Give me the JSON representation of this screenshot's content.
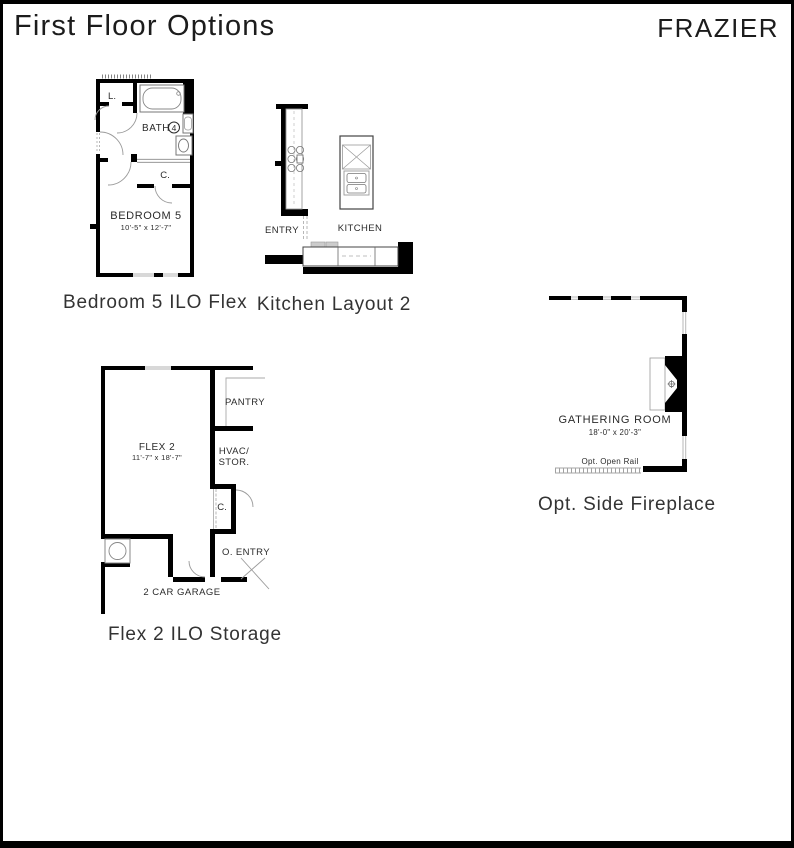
{
  "header": {
    "title": "First Floor Options",
    "brand": "FRAZIER"
  },
  "plans": {
    "bedroom5": {
      "caption": "Bedroom 5 ILO Flex",
      "linen": "L.",
      "bath": "BATH",
      "bath_number": "4",
      "closet": "C.",
      "room": "BEDROOM 5",
      "dims": "10'-5\" x 12'-7\""
    },
    "kitchen": {
      "caption": "Kitchen Layout 2",
      "entry": "ENTRY",
      "kitchen": "KITCHEN"
    },
    "fireplace": {
      "caption": "Opt. Side Fireplace",
      "room": "GATHERING ROOM",
      "dims": "18'-0\" x 20'-3\"",
      "rail": "Opt. Open Rail"
    },
    "flex": {
      "caption": "Flex 2 ILO Storage",
      "pantry": "PANTRY",
      "room": "FLEX 2",
      "dims": "11'-7\" x 18'-7\"",
      "hvac_line1": "HVAC/",
      "hvac_line2": "STOR.",
      "closet": "C.",
      "o_entry": "O. ENTRY",
      "garage": "2 CAR GARAGE"
    }
  },
  "colors": {
    "wall": "#000000",
    "text": "#2b2b2b"
  }
}
